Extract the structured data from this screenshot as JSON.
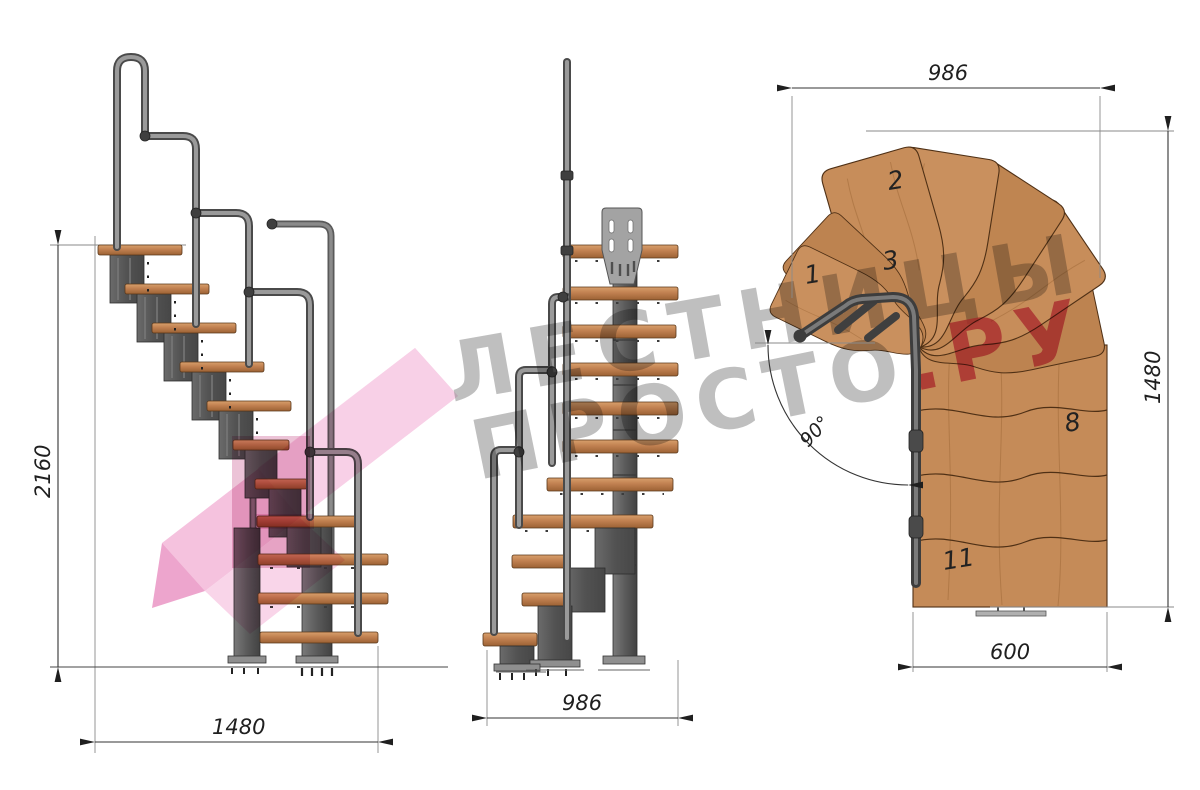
{
  "watermark": {
    "word1": "ЛЕСТНИЦЫ",
    "word2": "ПРОСТО",
    "word2_suffix": ".РУ"
  },
  "side_view": {
    "height_label": "2160",
    "run_label": "1480"
  },
  "front_view": {
    "width_label": "986"
  },
  "plan_view": {
    "width_label": "986",
    "depth_label": "1480",
    "exit_width_label": "600",
    "angle_label": "90°",
    "step_labels": {
      "s1": "1",
      "s2": "2",
      "s3": "3",
      "s8": "8",
      "s11": "11"
    }
  },
  "colors": {
    "watermark_gray": "#8a8a8a",
    "watermark_pink": "#d94f7e",
    "wood": "#c58b58",
    "metal": "#585858",
    "highlight_pink": "#f2aed3"
  }
}
